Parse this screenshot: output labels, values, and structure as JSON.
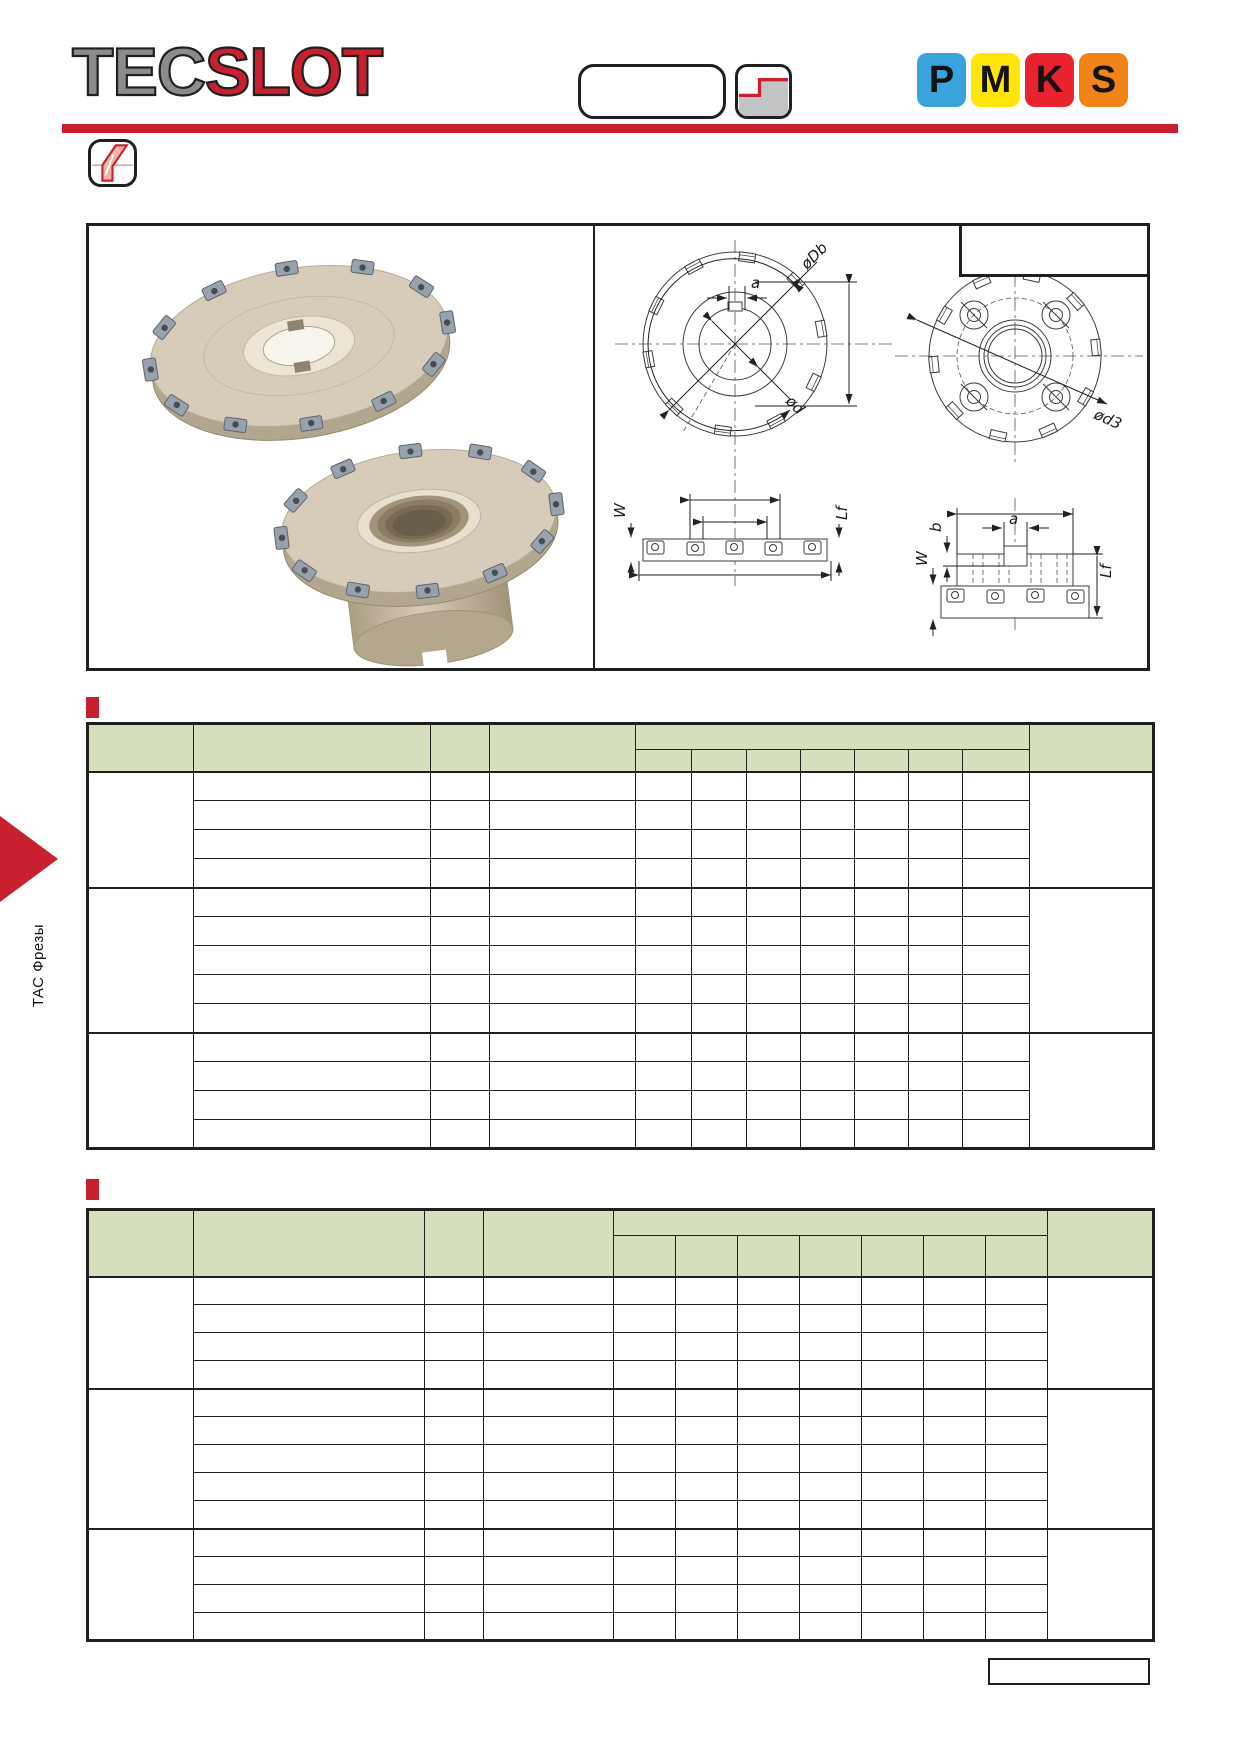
{
  "brand": {
    "tec": "TEC",
    "slot": "SLOT"
  },
  "material_classes": [
    {
      "label": "P",
      "color": "#3aa3db"
    },
    {
      "label": "M",
      "color": "#ffe50a"
    },
    {
      "label": "K",
      "color": "#e8222e"
    },
    {
      "label": "S",
      "color": "#f08419"
    }
  ],
  "sidebar": {
    "section_label": "ТАС Фрезы"
  },
  "figure": {
    "labels": {
      "oDb": "øDb",
      "a": "a",
      "od": "ød",
      "od3": "ød3",
      "W": "W",
      "Lf": "Lf",
      "b": "b"
    }
  },
  "tables": [
    {
      "name": "dimension-table-1",
      "header_sub_columns": 7,
      "body_columns": 12,
      "row_groups": [
        4,
        5,
        4
      ]
    },
    {
      "name": "dimension-table-2",
      "header_sub_columns": 7,
      "body_columns": 12,
      "row_groups": [
        4,
        5,
        4
      ]
    }
  ],
  "colors": {
    "accent_red": "#c8202f",
    "table_header_green": "#d5debd",
    "line_black": "#1f1f1f"
  }
}
